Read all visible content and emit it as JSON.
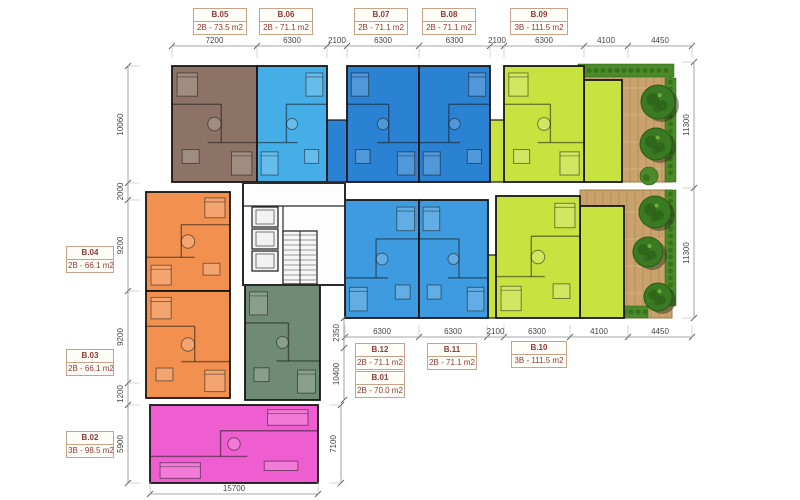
{
  "plan": {
    "width": 800,
    "height": 500,
    "kind": "apartment-floor-plan"
  },
  "colors": {
    "background": "#ffffff",
    "wall": "#161616",
    "dim_line": "#8a8a8a",
    "dim_tick": "#666666",
    "dim_ext": "#c2c2c2",
    "dim_text": "#454545",
    "label_border": "#c9a287",
    "label_bg": "#fffdf8",
    "label_text": "#8c3a34",
    "wood": "#c9a26e",
    "wood_grain": "#ab834f",
    "tree": "#3a7a22",
    "tree_dark": "#2a5c17",
    "tree_shadow": "rgba(35,45,20,0.45)",
    "hedge": "#4a8a28",
    "core_fill": "#fdfdfd",
    "unit_line": "rgba(20,20,20,0.5)",
    "furniture_fill": "rgba(255,255,255,0.18)"
  },
  "units": [
    {
      "id": "B.05",
      "type": "2B",
      "area": "73.5 m2",
      "color": "#8d7365",
      "x": 172,
      "y": 66,
      "w": 85,
      "h": 116
    },
    {
      "id": "B.06",
      "type": "2B",
      "area": "71.1 m2",
      "color": "#45aee6",
      "x": 257,
      "y": 66,
      "w": 70,
      "h": 116
    },
    {
      "id": "B.07",
      "type": "2B",
      "area": "71.1 m2",
      "color": "#2b82d3",
      "x": 347,
      "y": 66,
      "w": 72,
      "h": 116
    },
    {
      "id": "B.08",
      "type": "2B",
      "area": "71.1 m2",
      "color": "#2b82d3",
      "x": 419,
      "y": 66,
      "w": 71,
      "h": 116
    },
    {
      "id": "B.09",
      "type": "3B",
      "area": "111.5 m2",
      "color": "#c8e23f",
      "x": 504,
      "y": 66,
      "w": 80,
      "h": 116,
      "ext": [
        584,
        80,
        38,
        102
      ]
    },
    {
      "id": "B.04",
      "type": "2B",
      "area": "66.1 m2",
      "color": "#f2914f",
      "x": 146,
      "y": 192,
      "w": 84,
      "h": 99
    },
    {
      "id": "B.03",
      "type": "2B",
      "area": "66.1 m2",
      "color": "#f2914f",
      "x": 146,
      "y": 291,
      "w": 84,
      "h": 107
    },
    {
      "id": "B.12",
      "type": "2B",
      "area": "71.1 m2",
      "color": "#3f9bdf",
      "x": 345,
      "y": 200,
      "w": 74,
      "h": 118
    },
    {
      "id": "B.11",
      "type": "2B",
      "area": "71.1 m2",
      "color": "#3f9bdf",
      "x": 419,
      "y": 200,
      "w": 69,
      "h": 118
    },
    {
      "id": "B.10",
      "type": "3B",
      "area": "111.5 m2",
      "color": "#c8e23f",
      "x": 496,
      "y": 196,
      "w": 84,
      "h": 122,
      "ext": [
        580,
        206,
        44,
        112
      ]
    },
    {
      "id": "B.01",
      "type": "2B",
      "area": "70.0 m2",
      "color": "#6f8a75",
      "x": 245,
      "y": 285,
      "w": 75,
      "h": 115
    },
    {
      "id": "B.02",
      "type": "3B",
      "area": "98.5 m2",
      "color": "#ef5ed0",
      "x": 150,
      "y": 405,
      "w": 168,
      "h": 78
    }
  ],
  "fillers": [
    {
      "x": 327,
      "y": 120,
      "w": 20,
      "h": 62,
      "color": "#2b82d3"
    },
    {
      "x": 490,
      "y": 120,
      "w": 14,
      "h": 62,
      "color": "#c8e23f"
    },
    {
      "x": 488,
      "y": 255,
      "w": 8,
      "h": 63,
      "color": "#c8e23f"
    }
  ],
  "decks": [
    {
      "x": 583,
      "y": 66,
      "w": 89,
      "h": 116,
      "hedges": [
        [
          578,
          64,
          96,
          13
        ],
        [
          665,
          78,
          11,
          104
        ]
      ],
      "trees": [
        [
          658,
          102,
          17
        ],
        [
          656,
          144,
          16
        ]
      ],
      "bushes": [
        [
          649,
          176,
          9
        ],
        [
          590,
          172,
          7
        ]
      ]
    },
    {
      "x": 580,
      "y": 190,
      "w": 92,
      "h": 128,
      "hedges": [
        [
          578,
          306,
          70,
          12
        ],
        [
          665,
          190,
          11,
          116
        ]
      ],
      "trees": [
        [
          655,
          212,
          16
        ],
        [
          648,
          252,
          15
        ],
        [
          658,
          297,
          14
        ]
      ],
      "bushes": [
        [
          590,
          300,
          7
        ]
      ]
    }
  ],
  "core": {
    "x": 243,
    "y": 183,
    "w": 102,
    "h": 102,
    "elevators": [
      [
        252,
        207,
        26,
        20
      ],
      [
        252,
        229,
        26,
        20
      ],
      [
        252,
        251,
        26,
        20
      ]
    ],
    "stairs": [
      283,
      231,
      34,
      53
    ],
    "wall_lines": [
      [
        243,
        206,
        345,
        206
      ],
      [
        283,
        206,
        283,
        284
      ]
    ]
  },
  "callouts": [
    {
      "unit": "B.05",
      "size": "2B - 73.5 m2",
      "x": 193,
      "y": 8,
      "w": 54
    },
    {
      "unit": "B.06",
      "size": "2B - 71.1 m2",
      "x": 259,
      "y": 8,
      "w": 54
    },
    {
      "unit": "B.07",
      "size": "2B - 71.1 m2",
      "x": 354,
      "y": 8,
      "w": 54
    },
    {
      "unit": "B.08",
      "size": "2B - 71.1 m2",
      "x": 422,
      "y": 8,
      "w": 54
    },
    {
      "unit": "B.09",
      "size": "3B - 111.5 m2",
      "x": 510,
      "y": 8,
      "w": 58
    },
    {
      "unit": "B.04",
      "size": "2B - 66.1 m2",
      "x": 66,
      "y": 246,
      "w": 48
    },
    {
      "unit": "B.03",
      "size": "2B - 66.1 m2",
      "x": 66,
      "y": 349,
      "w": 48
    },
    {
      "unit": "B.02",
      "size": "3B - 98.5 m2",
      "x": 66,
      "y": 431,
      "w": 48
    },
    {
      "unit": "B.12",
      "size": "2B - 71.1 m2",
      "x": 355,
      "y": 343,
      "w": 50
    },
    {
      "unit": "B.11",
      "size": "2B - 71.1 m2",
      "x": 427,
      "y": 343,
      "w": 50
    },
    {
      "unit": "B.10",
      "size": "3B - 111.5 m2",
      "x": 511,
      "y": 341,
      "w": 56
    },
    {
      "unit": "B.01",
      "size": "2B - 70.0 m2",
      "x": 355,
      "y": 371,
      "w": 50
    }
  ],
  "dims": {
    "top": {
      "axis": "x",
      "line": 46,
      "ticks": [
        172,
        257,
        327,
        347,
        419,
        490,
        504,
        584,
        628,
        692
      ],
      "values": [
        "7200",
        "6300",
        "2100",
        "6300",
        "6300",
        "2100",
        "6300",
        "4100",
        "4450"
      ]
    },
    "middle": {
      "axis": "x",
      "line": 337,
      "ticks": [
        345,
        419,
        487,
        504,
        570,
        628,
        692
      ],
      "values": [
        "6300",
        "6300",
        "2100",
        "6300",
        "4100",
        "4450"
      ]
    },
    "bottom": {
      "axis": "x",
      "line": 494,
      "ticks": [
        150,
        318
      ],
      "values": [
        "15700"
      ]
    },
    "left": {
      "axis": "y",
      "line": 128,
      "ticks": [
        66,
        183,
        200,
        291,
        383,
        405,
        483
      ],
      "values": [
        "10060",
        "2000",
        "9200",
        "9200",
        "1200",
        "5900"
      ]
    },
    "right": {
      "axis": "y",
      "line": 694,
      "ticks": [
        62,
        188,
        318
      ],
      "values": [
        "11300",
        "11300"
      ]
    },
    "inner": {
      "axis": "y",
      "line": 344,
      "ticks": [
        318,
        348,
        400
      ],
      "values": [
        "2350",
        "10400"
      ]
    },
    "pink_right": {
      "axis": "y",
      "line": 341,
      "ticks": [
        405,
        483
      ],
      "values": [
        "7100"
      ]
    }
  }
}
